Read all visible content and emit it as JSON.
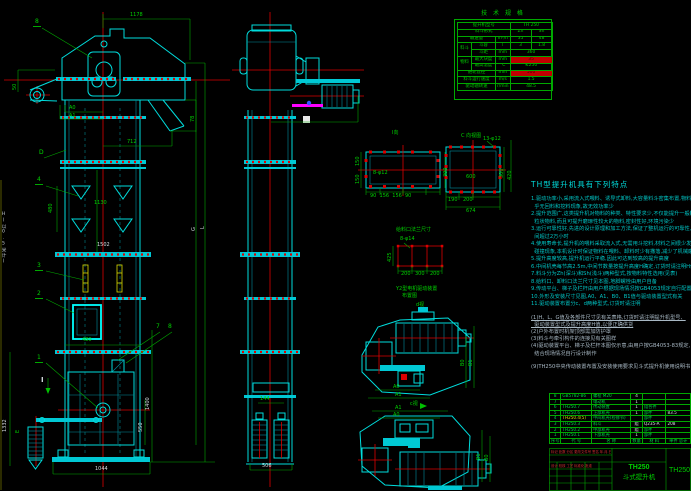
{
  "spec": {
    "title": "技 术 规 格",
    "r1_label": "提升机型号",
    "r1_value": "TH 250",
    "r2_label": "料斗形式",
    "r2_v1": "Zh",
    "r2_v2": "Sh",
    "r3_label": "输送量",
    "r3_unit": "m³/h",
    "r3_v1": "35",
    "r3_v2": "48",
    "r4_group": "料斗",
    "r4_label": "斗容",
    "r4_unit": "l",
    "r4_v1": "3",
    "r4_v2": "1.8",
    "r5_label": "斗距",
    "r5_unit": "mm",
    "r5_value": "360",
    "r6_group": "物料",
    "r6_label": "最大块度",
    "r6_unit": "mm",
    "r6_value": "35",
    "r7_label": "最高温度",
    "r7_unit": "℃",
    "r7_value": "≤250",
    "r8_label": "链轮直径",
    "r8_unit": "mm",
    "r8_value": "500",
    "r9_label": "料斗运行速度",
    "r9_unit": "m/s",
    "r9_value": "1.5",
    "r10_label": "驱动轴转速",
    "r10_unit": "r/min",
    "r10_value": "48.5"
  },
  "front": {
    "dim_top": "1178",
    "balloon_8": "8",
    "dim_50": "50",
    "label_a0": "A0",
    "label_a1": "A1",
    "dim_712": "712",
    "dim_78": "78",
    "label_d": "D",
    "balloon_4": "4",
    "dim_480_mid": "480",
    "dim_1130": "1130",
    "dim_1502": "1502",
    "label_h": "H(以0.5米计)",
    "label_g": "G",
    "label_l": "L",
    "balloon_3": "3",
    "balloon_2": "2",
    "label_7": "7",
    "label_8": "8",
    "dim_480_boot": "480",
    "balloon_1": "1",
    "section_mark": "I",
    "label_e": "E",
    "dim_1332": "1332",
    "dim_1400": "1400",
    "dim_550": "550",
    "dim_1044": "1044"
  },
  "side": {
    "dim_144": "144",
    "dim_506": "506"
  },
  "details": {
    "view_i": {
      "title": "I向",
      "holes": "8-φ12",
      "dim_left_top": "150",
      "dim_left_bottom": "150",
      "dim_right": "300",
      "dims_bottom": "90  156  156  90"
    },
    "view_c": {
      "title": "C 向视图",
      "holes": "13-φ12",
      "dim_inner": "600",
      "dim_b1": "190",
      "dim_b2": "200",
      "dim_total": "674",
      "dim_r1": "300",
      "dim_r2": "420"
    },
    "feed": {
      "title": "给料口法兰尺寸",
      "holes": "8-φ14",
      "dim_left": "425",
      "dim_b1": "200",
      "dim_b2": "300",
      "dim_b3": "200"
    },
    "drive": {
      "caption1": "Y2型电机驱动装置",
      "caption2": "布置图",
      "view_d_label": "d视",
      "view_c_label": "c视",
      "upper": {
        "a0": "A0",
        "a1": "A1",
        "b0": "B0",
        "b1": "B1"
      },
      "lower": {
        "a1": "A1",
        "a0": "A0",
        "b1": "B1",
        "b0": "B0"
      }
    }
  },
  "features": {
    "title": "TH型提升机具有下列特点",
    "lines": [
      "1.驱动功率小,采用流入式喂料、诱导式卸料,大容量料斗密集布置,物料提升时几",
      "  乎无回料和挖料现象,故无效功率少",
      "2.提升范围广,这类提升机对物料的种类、特性要求少,不仅能提升一般粉状、小颗",
      "  粒状物料,而且可提升磨琢性较大的物料,密封性好,环境污染少",
      "3.运行可靠性好,先进的设计原理和加工方法,保证了整机运行的可靠性,无故障时",
      "  间超过2万小时",
      "4.使用寿命长,提升机的喂料采取流入式,无需用斗挖料,材料之间很少发生挤压和",
      "  碰撞现象,本机设计时保证物料在喂料、卸料时少有撒落,减少了机械磨损",
      "5.提升高度较高,提升机运行平稳,因此可达到较高的提升高度",
      "6.中间机壳每节高2.5m,中间节数量按提升高度H确定,订货时请注明H值",
      "7.料斗分为Zh(深斗)和Sh(浅斗)两种型式,按物料特性选用(见表)",
      "8.给料口、卸料口法兰尺寸见本图,地脚螺栓由用户自备",
      "9.传动平台、梯子及栏杆由用户根据现场情况按GB4053规定自行配置",
      "10.外形及安装尺寸见图,A0、A1、B0、B1值与驱动装置型式有关",
      "11.驱动装置布置分c、d两种型式,订货时请注明"
    ],
    "notes": [
      "(1)H、L、G值及各部件尺寸见有关表格,订货时请注明提升机型号、",
      "  驱动装置型式及提升高度H值,以便正确供货",
      "(2)户外布置时机架顶部需加防护罩",
      "(3)料斗与牵引构件的连接见有关图样",
      "(4)驱动装置平台、梯子及栏杆本图仅示意,由用户按GB4053-83规定,",
      "  结合现场情况自行设计制作",
      "(9)TH250中央传动装置布置及安装使用要求见斗式提升机使用说明书"
    ]
  },
  "bom": {
    "header": {
      "no": "序号",
      "code": "代  号",
      "name": "名  称",
      "qty": "数量",
      "mat": "材  料",
      "wt": "单件 总计"
    },
    "rows": [
      {
        "no": "8",
        "code": "GB5782-86",
        "name": "螺栓 M20",
        "qty": "4",
        "mat": "",
        "wt": ""
      },
      {
        "no": "7",
        "code": "",
        "name": "电动机",
        "qty": "1",
        "mat": "",
        "wt": ""
      },
      {
        "no": "6",
        "code": "TH250.7",
        "name": "传动装置",
        "qty": "1",
        "mat": "组合件",
        "wt": ""
      },
      {
        "no": "5",
        "code": "TH250.6",
        "name": "上部机壳",
        "qty": "1",
        "mat": "部件",
        "wt": "83.5"
      },
      {
        "no": "4",
        "code": "TH250.4(5)",
        "name": "中间机壳(检修节)",
        "qty": "",
        "mat": "部件",
        "wt": ""
      },
      {
        "no": "3",
        "code": "TH250.3",
        "name": "料斗",
        "qty": "组",
        "mat": "Q235-A",
        "wt": "208"
      },
      {
        "no": "2",
        "code": "TH250.2",
        "name": "中部机壳",
        "qty": "组",
        "mat": "部件",
        "wt": ""
      },
      {
        "no": "1",
        "code": "TH250.1",
        "name": "下部机壳",
        "qty": "1",
        "mat": "部件",
        "wt": ""
      }
    ]
  },
  "title_block": {
    "model": "TH250",
    "product": "斗式提升机",
    "code": "TH250",
    "rev_row": "标记 处数 分区 更改文件号 签名 年.月.日",
    "sign_row": "设计   校核   工艺   标准化   批准"
  }
}
